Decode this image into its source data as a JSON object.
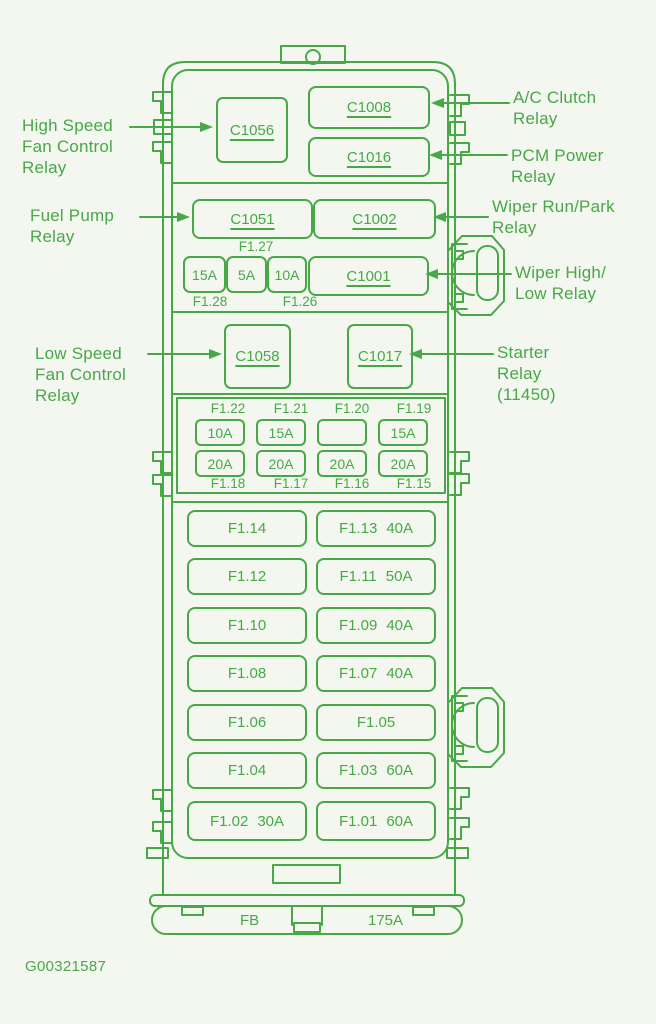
{
  "colors": {
    "ink": "#48a847",
    "background": "#f3f7f0"
  },
  "caption": "G00321587",
  "callouts": {
    "high_speed_fan": "High Speed\nFan Control\nRelay",
    "fuel_pump": "Fuel Pump\nRelay",
    "low_speed_fan": "Low Speed\nFan Control\nRelay",
    "ac_clutch": "A/C Clutch\nRelay",
    "pcm_power": "PCM Power\nRelay",
    "wiper_run_park": "Wiper Run/Park\nRelay",
    "wiper_high_low": "Wiper High/\nLow Relay",
    "starter": "Starter\nRelay\n(11450)"
  },
  "relays": {
    "c1056": "C1056",
    "c1008": "C1008",
    "c1016": "C1016",
    "c1051": "C1051",
    "c1002": "C1002",
    "c1001": "C1001",
    "c1058": "C1058",
    "c1017": "C1017"
  },
  "mini_fuses": {
    "f127_label": "F1.27",
    "row": [
      "15A",
      "5A",
      "10A"
    ],
    "f128_label": "F1.28",
    "f126_label": "F1.26"
  },
  "fuse_grid": {
    "top_labels": [
      "F1.22",
      "F1.21",
      "F1.20",
      "F1.19"
    ],
    "top_row": [
      "10A",
      "15A",
      "",
      "15A"
    ],
    "bottom_row": [
      "20A",
      "20A",
      "20A",
      "20A"
    ],
    "bottom_labels": [
      "F1.18",
      "F1.17",
      "F1.16",
      "F1.15"
    ]
  },
  "large_fuses": [
    {
      "left": {
        "name": "F1.14",
        "amp": ""
      },
      "right": {
        "name": "F1.13",
        "amp": "40A"
      }
    },
    {
      "left": {
        "name": "F1.12",
        "amp": ""
      },
      "right": {
        "name": "F1.11",
        "amp": "50A"
      }
    },
    {
      "left": {
        "name": "F1.10",
        "amp": ""
      },
      "right": {
        "name": "F1.09",
        "amp": "40A"
      }
    },
    {
      "left": {
        "name": "F1.08",
        "amp": ""
      },
      "right": {
        "name": "F1.07",
        "amp": "40A"
      }
    },
    {
      "left": {
        "name": "F1.06",
        "amp": ""
      },
      "right": {
        "name": "F1.05",
        "amp": ""
      }
    },
    {
      "left": {
        "name": "F1.04",
        "amp": ""
      },
      "right": {
        "name": "F1.03",
        "amp": "60A"
      }
    },
    {
      "left": {
        "name": "F1.02",
        "amp": "30A"
      },
      "right": {
        "name": "F1.01",
        "amp": "60A"
      }
    }
  ],
  "bottom_bar": {
    "left": "FB",
    "right": "175A"
  }
}
